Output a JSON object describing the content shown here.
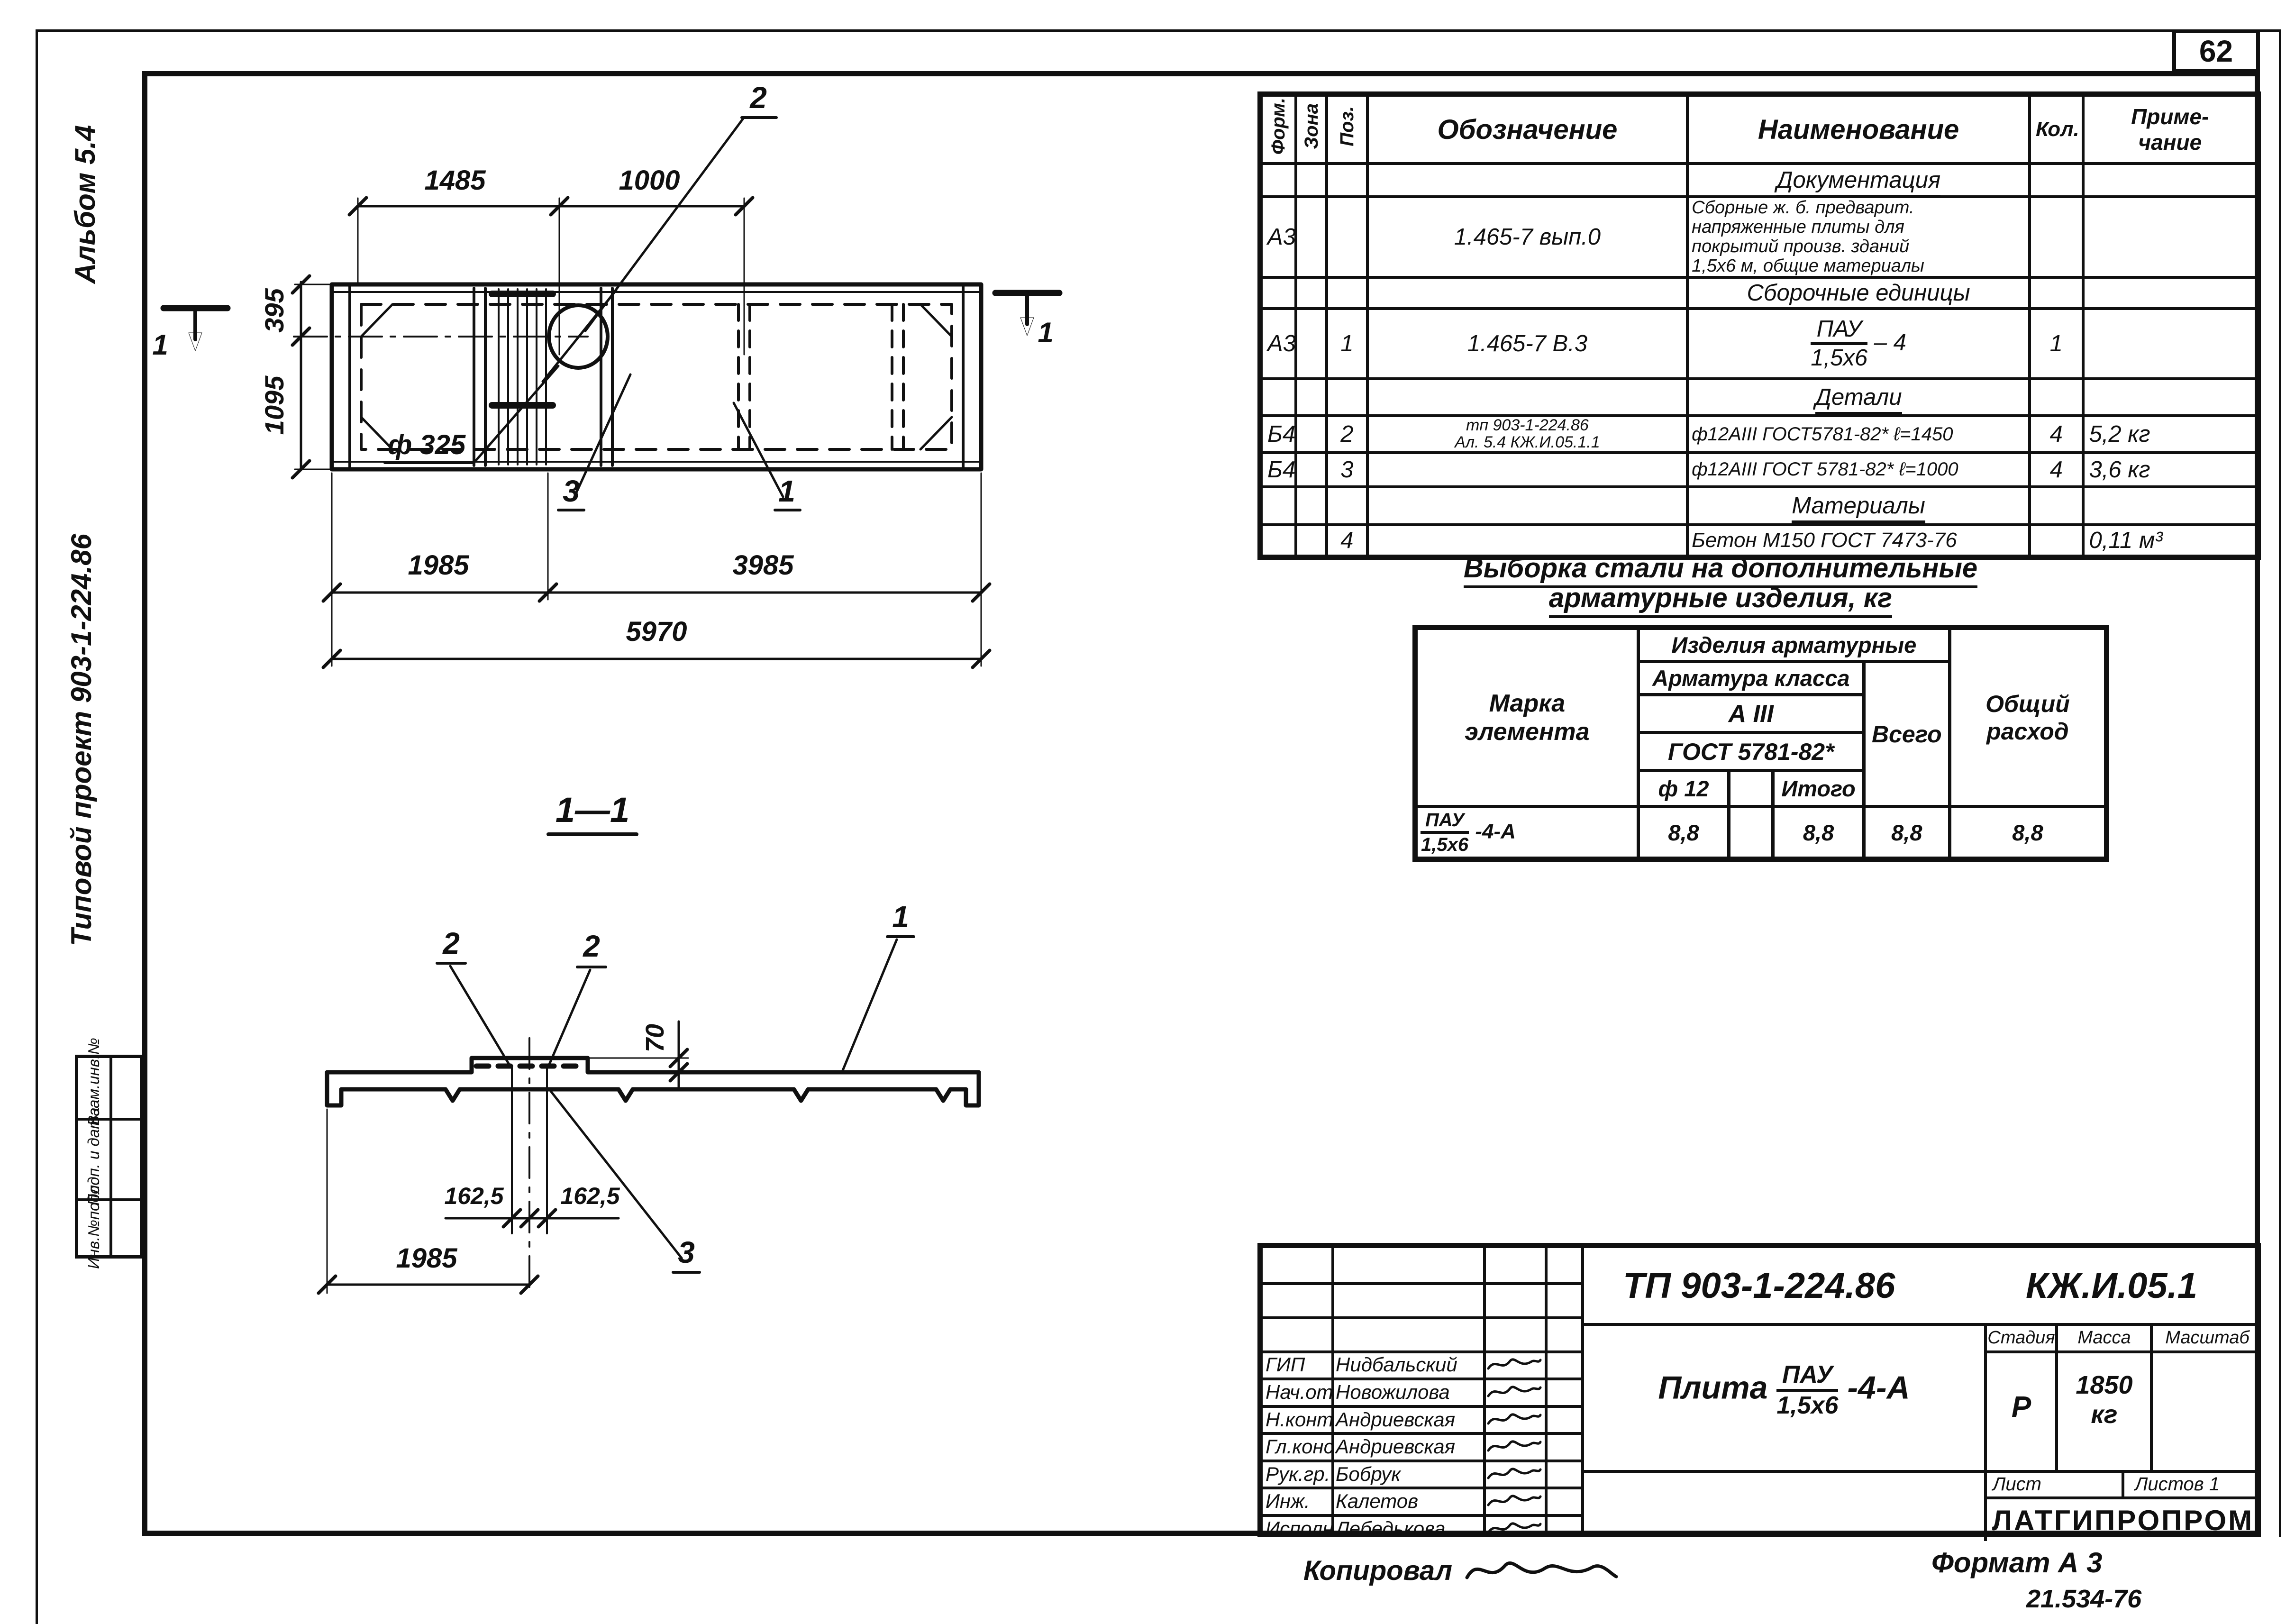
{
  "sheet": {
    "page_number": "62",
    "copied_label": "Копировал",
    "format_note": "Формат А 3",
    "footer_number": "21.534-76"
  },
  "left_margin": {
    "album": "Альбом 5.4",
    "project": "Типовой   проект  903-1-224.86",
    "stamps": [
      "Взам.инв.№",
      "Подп. и дата",
      "Инв.№подл."
    ]
  },
  "plan_view": {
    "dim_top_1": "1485",
    "dim_top_2": "1000",
    "dim_left_1": "395",
    "dim_left_2": "1095",
    "dim_bottom_1": "1985",
    "dim_bottom_2": "3985",
    "dim_bottom_total": "5970",
    "pipe_label": "ф 325",
    "callout_2": "2",
    "callout_3": "3",
    "callout_1": "1",
    "section_mark": "1"
  },
  "section_view": {
    "title": "1—1",
    "callout_2a": "2",
    "callout_2b": "2",
    "callout_1": "1",
    "callout_3": "3",
    "dim_height": "70",
    "dim_offset_left": "162,5",
    "dim_offset_right": "162,5",
    "dim_bottom": "1985"
  },
  "spec_table": {
    "col_format": "Форм.",
    "col_zone": "Зона",
    "col_pos": "Поз.",
    "col_designation": "Обозначение",
    "col_name": "Наименование",
    "col_qty": "Кол.",
    "col_note": "Приме-\nчание",
    "rows": [
      {
        "title": "Документация"
      },
      {
        "format": "А3",
        "pos": "",
        "designation": "1.465-7 вып.0",
        "name": "Сборные  ж. б. предварит.\nнапряженные плиты для\nпокрытий произв. зданий\n1,5х6 м,  общие материалы",
        "qty": "",
        "note": ""
      },
      {
        "title": "Сборочные единицы"
      },
      {
        "format": "А3",
        "pos": "1",
        "designation": "1.465-7 В.3",
        "name_num": "ПАУ",
        "name_den": "1,5х6",
        "name_suffix": "– 4",
        "qty": "1",
        "note": ""
      },
      {
        "title": "Детали"
      },
      {
        "format": "Б4",
        "pos": "2",
        "designation": "тп 903-1-224.86\nАл. 5.4      КЖ.И.05.1.1",
        "name": "ф12АIII ГОСТ5781-82*  ℓ=1450",
        "qty": "4",
        "note": "5,2 кг"
      },
      {
        "format": "Б4",
        "pos": "3",
        "designation": "",
        "name": "ф12АIII ГОСТ 5781-82*  ℓ=1000",
        "qty": "4",
        "note": "3,6 кг"
      },
      {
        "title": "Материалы"
      },
      {
        "format": "",
        "pos": "4",
        "designation": "",
        "name": "Бетон М150 ГОСТ 7473-76",
        "qty": "",
        "note": "0,11 м³"
      }
    ]
  },
  "steel_table": {
    "title_line1": "Выборка стали на дополнительные",
    "title_line2": "арматурные   изделия, кг",
    "col_mark": "Марка\nэлемента",
    "group_header": "Изделия арматурные",
    "sub_header": "Арматура класса",
    "class_label": "А III",
    "gost_label": "ГОСТ 5781-82*",
    "dia_label": "ф 12",
    "itogo_label": "Итого",
    "vsego_label": "Всего",
    "total_label": "Общий\nрасход",
    "row": {
      "mark_num": "ПАУ",
      "mark_den": "1,5х6",
      "mark_suffix": "-4-А",
      "d12": "8,8",
      "blank": "",
      "itogo": "8,8",
      "vsego": "8,8",
      "total": "8,8"
    }
  },
  "title_block": {
    "doc_code": "ТП 903-1-224.86",
    "drawing_code": "КЖ.И.05.1",
    "item_label": "Плита",
    "item_num": "ПАУ",
    "item_den": "1,5х6",
    "item_suffix": "-4-А",
    "stage_label": "Стадия",
    "mass_label": "Масса",
    "scale_label": "Масштаб",
    "stage": "Р",
    "mass_value": "1850\nкг",
    "scale": "",
    "sheet_label": "Лист",
    "sheets_label": "Листов 1",
    "organization": "ЛАТГИПРОПРОМ",
    "signatures": [
      {
        "role": "ГИП",
        "name": "Нидбальский"
      },
      {
        "role": "Нач.отд.",
        "name": "Новожилова"
      },
      {
        "role": "Н.контр.",
        "name": "Андриевская"
      },
      {
        "role": "Гл.конст.",
        "name": "Андриевская"
      },
      {
        "role": "Рук.гр.",
        "name": "Бобрук"
      },
      {
        "role": "Инж.",
        "name": "Калетов"
      },
      {
        "role": "Исполн.",
        "name": "Лебедькова"
      }
    ]
  }
}
